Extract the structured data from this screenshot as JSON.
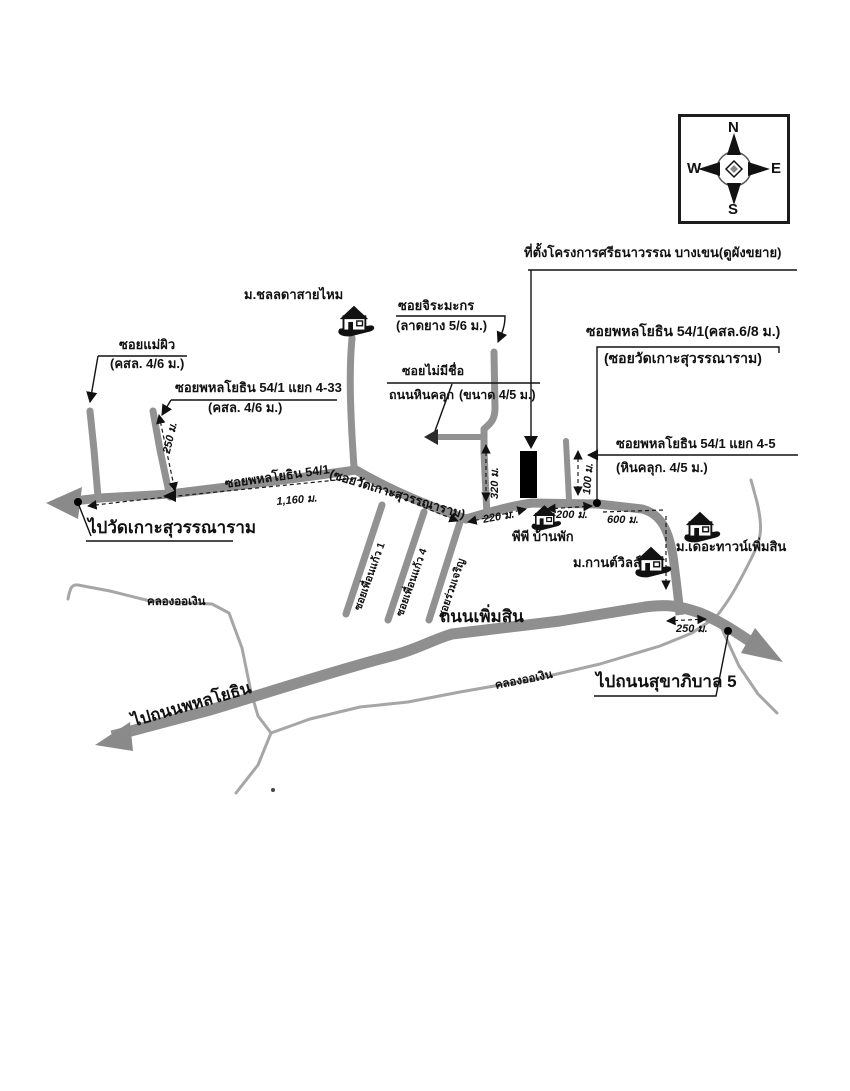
{
  "colors": {
    "road": "#919191",
    "canal": "#a6a6a6",
    "ink": "#111111",
    "site_marker": "#000000"
  },
  "compass": {
    "n": "N",
    "e": "E",
    "s": "S",
    "w": "W"
  },
  "labels": {
    "project_site": "ที่ตั้งโครงการศรีธนาวรรณ บางเขน(ดูผังขยาย)",
    "soi_phahon_54_1": "ซอยพหลโยธิน 54/1(คสล.6/8 ม.)",
    "soi_wat_kao_alias": "(ซอยวัดเกาะสุวรรณาราม)",
    "soi_phahon_54_1_yaek_4_5": "ซอยพหลโยธิน 54/1 แยก 4-5",
    "yaek_4_5_surface": "(หินคลุก. 4/5 ม.)",
    "mu_chonlada": "ม.ชลลดาสายไหม",
    "soi_jiramakorn": "ซอยจิระมะกร",
    "jiramakorn_surface": "(ลาดยาง 5/6 ม.)",
    "soi_no_name": "ซอยไม่มีชื่อ",
    "gravel_road": "ถนนหินคลุก",
    "gravel_size": "(ขนาด 4/5 ม.)",
    "soi_maephew": "ซอยแม่ผิว",
    "maephew_surface": "(คสล. 4/6 ม.)",
    "soi_phahon_54_1_yaek_4_33": "ซอยพหลโยธิน 54/1 แยก 4-33",
    "yaek_4_33_surface": "(คสล. 4/6 ม.)",
    "main_road_name": "ซอยพหลโยธิน 54/1",
    "main_road_alias": "(ซอยวัดเกาะสุวรรณาราม)",
    "to_wat_kao": "ไปวัดเกาะสุวรรณาราม",
    "pp_banpak": "พีพี บ้านพัก",
    "mu_the_town_permsin": "ม.เดอะทาวน์เพิ่มสิน",
    "mu_karn_ville": "ม.กานต์วิลล์",
    "thanon_permsin": "ถนนเพิ่มสิน",
    "to_sukhaphiban_5": "ไปถนนสุขาภิบาล 5",
    "to_phahonyothin": "ไปถนนพหลโยธิน",
    "khlong_or_ngoen_left": "คลองออเงิน",
    "khlong_or_ngoen_right": "คลองออเงิน",
    "soi_phuen_kaew_1": "ซอยเพื่อนแก้ว 1",
    "soi_phuen_kaew_4": "ซอยเพื่อนแก้ว 4",
    "soi_ruam_jaroen": "ซอยร่วมเจริญ"
  },
  "dimensions": {
    "main_1160": "1,160 ม.",
    "yaek_4_33_250": "250 ม.",
    "jiramakorn_320": "320 ม.",
    "yaek_4_5_100": "100 ม.",
    "seg_220": "220 ม.",
    "seg_200": "200 ม.",
    "seg_600": "600 ม.",
    "permsin_250": "250 ม."
  }
}
